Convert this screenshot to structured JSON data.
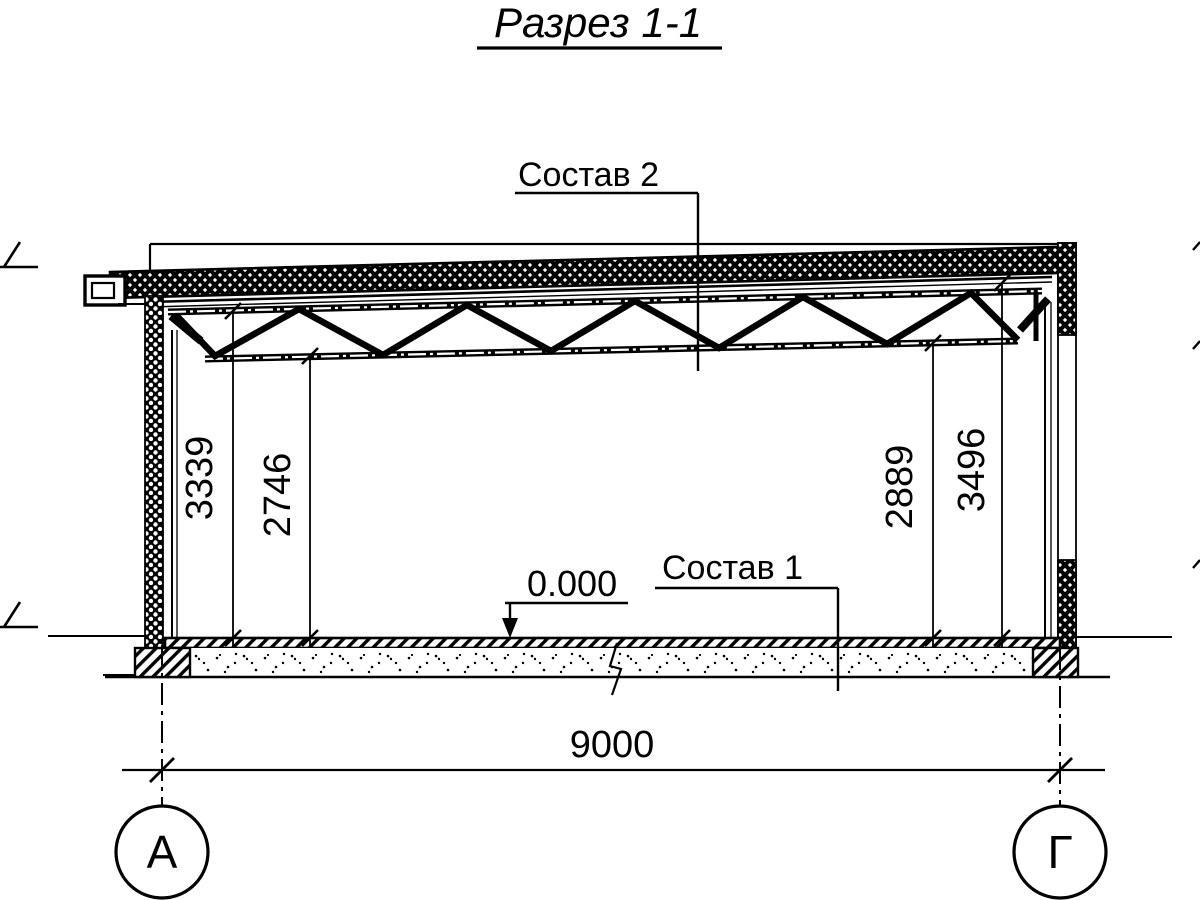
{
  "drawing": {
    "title": "Разрез 1-1",
    "callouts": {
      "roof": "Состав 2",
      "floor": "Состав 1",
      "level_mark": "0.000"
    },
    "dimensions": {
      "left_to_top_chord": "3339",
      "left_to_bottom_chord": "2746",
      "right_to_bottom_chord": "2889",
      "right_to_top_chord": "3496",
      "span": "9000"
    },
    "axes": {
      "left_label": "А",
      "right_label": "Г"
    },
    "colors": {
      "ink": "#000000",
      "paper": "#ffffff"
    }
  }
}
